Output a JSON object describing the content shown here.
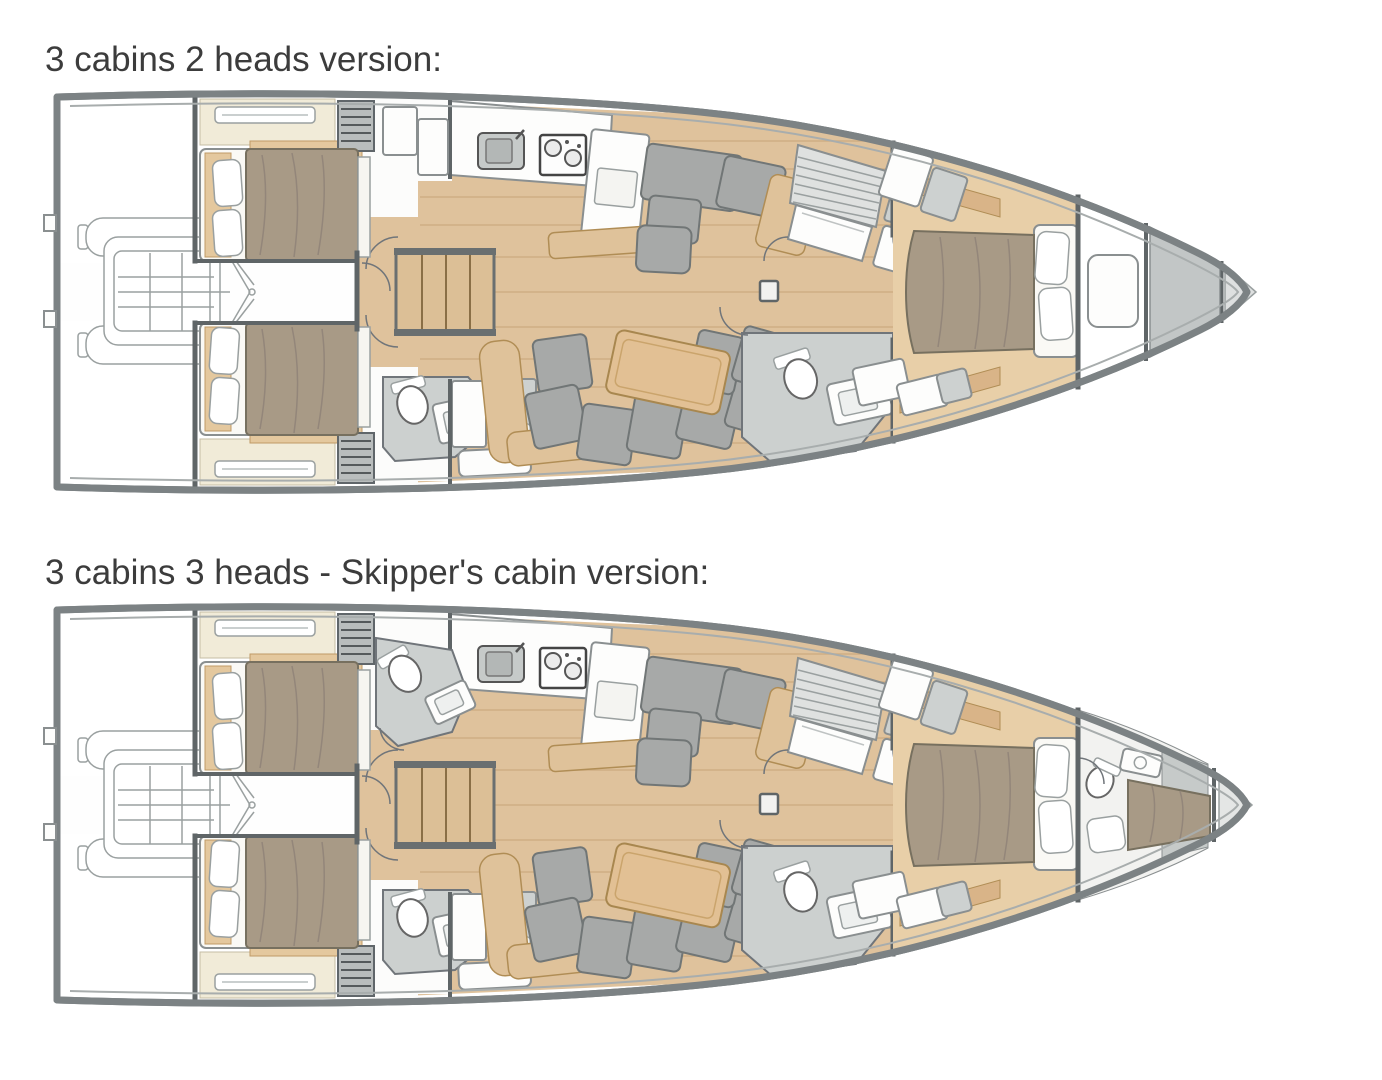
{
  "page": {
    "background_color": "#ffffff"
  },
  "sections": [
    {
      "id": "plan-3-cabins-2-heads",
      "title": "3 cabins 2 heads version:"
    },
    {
      "id": "plan-3-cabins-3-heads-skipper",
      "title": "3 cabins 3 heads - Skipper's cabin version:"
    }
  ],
  "palette": {
    "hull_outline": "#7c8284",
    "bulkhead": "#5f6567",
    "wood_floor": "#dfc29c",
    "wood_trim": "#e4c89e",
    "upholstery_gray": "#a7a9a8",
    "bedding_brown": "#a89a86",
    "cream_cabinetry": "#f1ebd8",
    "bathroom_floor": "#ccd0cf",
    "fore_peak_dark": "#c2c6c6",
    "fore_peak_light": "#dee0e0"
  }
}
